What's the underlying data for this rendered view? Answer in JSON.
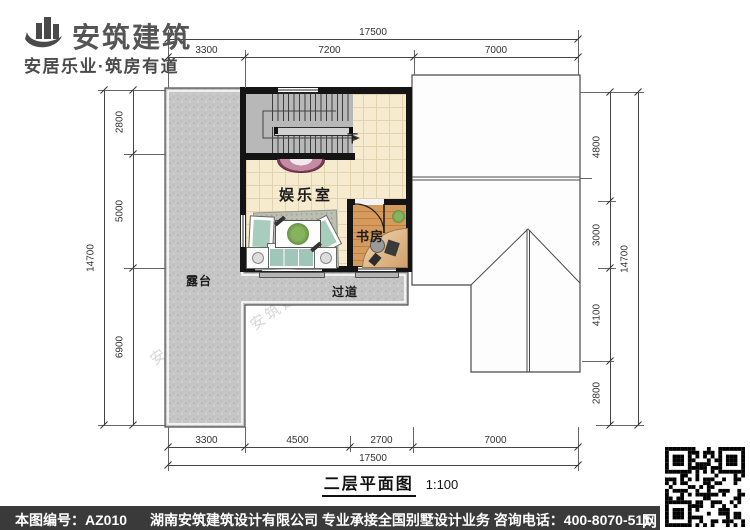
{
  "logo": {
    "name": "安筑建筑",
    "tagline": "安居乐业·筑房有道"
  },
  "title": {
    "name": "二层平面图",
    "scale": "1:100"
  },
  "rooms": {
    "entertainment": "娱乐室",
    "study": "书房",
    "terrace": "露台",
    "corridor": "过道",
    "stair_down": "下"
  },
  "dimensions": {
    "top": {
      "total": "17500",
      "segments": [
        "3300",
        "7200",
        "7000"
      ]
    },
    "bottom": {
      "total": "17500",
      "segments": [
        "3300",
        "4500",
        "2700",
        "7000"
      ]
    },
    "left": {
      "total": "14700",
      "segments": [
        "2800",
        "5000",
        "6900"
      ]
    },
    "right": {
      "total": "14700",
      "segments": [
        "4800",
        "3000",
        "4100",
        "2800"
      ]
    }
  },
  "footer": {
    "drawing_number": "本图编号：AZ010",
    "company_info": "湖南安筑建筑设计有限公司  专业承接全国别墅设计业务  咨询电话：400-8070-511",
    "web_label": "网"
  },
  "watermark": {
    "site": "hnazjz.com",
    "brand": "安筑建筑"
  },
  "colors": {
    "wall": "#141414",
    "terrace": "#c6c6c6",
    "tile": "#f7ebcf",
    "wood": "#cd9256",
    "console": "#7c3c58",
    "footer_bar": "#3a3a3a"
  }
}
